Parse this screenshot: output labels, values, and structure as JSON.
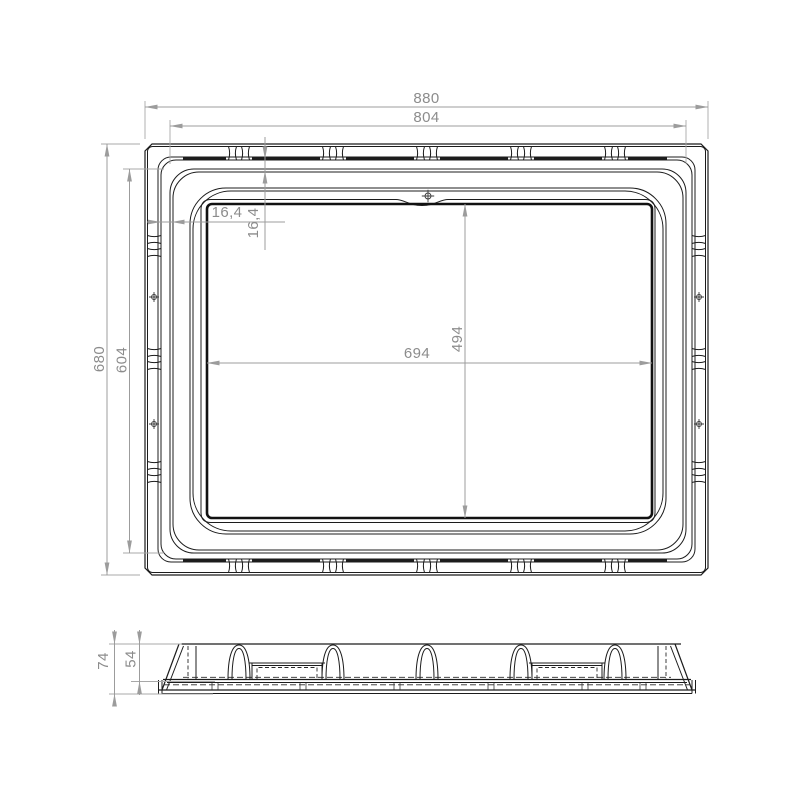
{
  "drawing": {
    "type": "technical-drawing",
    "views": {
      "top": "top-view",
      "side": "side-profile-view"
    },
    "dims": {
      "overall_width": "880",
      "rim_width": "804",
      "overall_height": "680",
      "rim_height": "604",
      "opening_width": "694",
      "opening_height": "494",
      "offset_h": "16,4",
      "offset_v": "16,4",
      "profile_total_height": "74",
      "profile_body_height": "54"
    },
    "colors": {
      "line": "#1c1c1c",
      "dimension": "#9c9c9c",
      "text": "#8c8c8c",
      "background": "#ffffff"
    }
  }
}
